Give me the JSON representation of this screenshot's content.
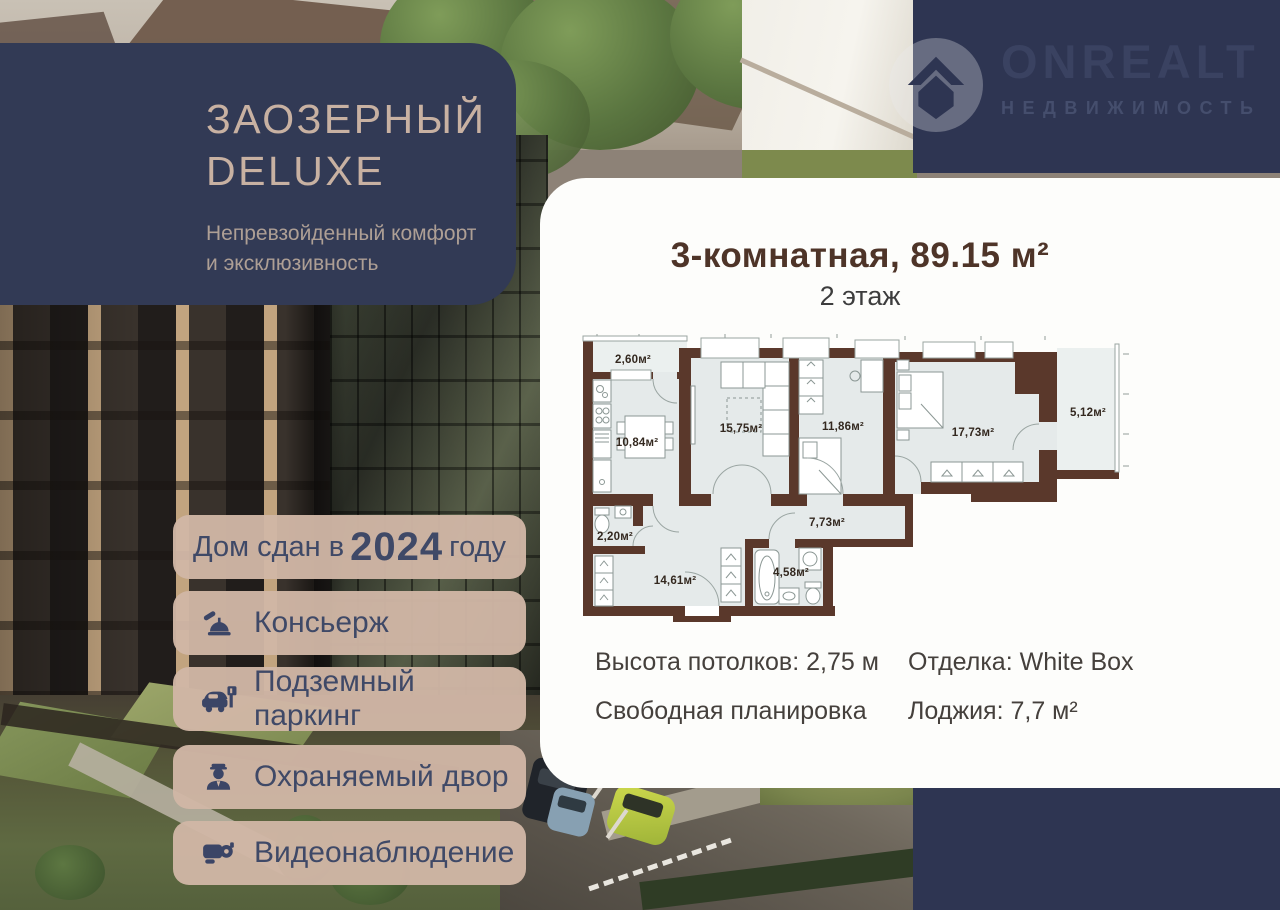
{
  "brand": {
    "logo_text": "ONREALT",
    "logo_sub": "НЕДВИЖИМОСТЬ"
  },
  "promo": {
    "title_line1": "ЗАОЗЕРНЫЙ",
    "title_line2": "DELUXE",
    "subtitle_line1": "Непревзойденный комфорт",
    "subtitle_line2": "и эксклюзивность"
  },
  "badges": {
    "completion": {
      "prefix": "Дом сдан в",
      "year": "2024",
      "suffix": "году"
    },
    "items": [
      {
        "icon": "bell-icon",
        "label": "Консьерж"
      },
      {
        "icon": "parking-icon",
        "label": "Подземный паркинг"
      },
      {
        "icon": "guard-icon",
        "label": "Охраняемый двор"
      },
      {
        "icon": "camera-icon",
        "label": "Видеонаблюдение"
      }
    ]
  },
  "listing": {
    "title": "3-комнатная, 89.15 м²",
    "floor": "2 этаж",
    "specs": [
      {
        "label": "Высота потолков: 2,75 м"
      },
      {
        "label": "Отделка: White Box"
      },
      {
        "label": "Свободная планировка"
      },
      {
        "label": "Лоджия: 7,7 м²"
      }
    ]
  },
  "floor_plan": {
    "rooms": [
      {
        "name": "balcony-top",
        "area": "2,60м²",
        "x": 58,
        "y": 29
      },
      {
        "name": "kitchen",
        "area": "10,84м²",
        "x": 62,
        "y": 112
      },
      {
        "name": "living-room",
        "area": "15,75м²",
        "x": 166,
        "y": 98
      },
      {
        "name": "bedroom-1",
        "area": "11,86м²",
        "x": 268,
        "y": 96
      },
      {
        "name": "bedroom-2",
        "area": "17,73м²",
        "x": 398,
        "y": 102
      },
      {
        "name": "loggia",
        "area": "5,12м²",
        "x": 513,
        "y": 82
      },
      {
        "name": "wc",
        "area": "2,20м²",
        "x": 40,
        "y": 206
      },
      {
        "name": "hallway",
        "area": "7,73м²",
        "x": 252,
        "y": 192
      },
      {
        "name": "hall-room",
        "area": "14,61м²",
        "x": 100,
        "y": 250
      },
      {
        "name": "bathroom",
        "area": "4,58м²",
        "x": 216,
        "y": 242
      }
    ]
  },
  "colors": {
    "navy": "#2e3552",
    "promo_navy": "#323a55",
    "promo_title": "#c8b1a2",
    "badge_bg": "#d0b6a5",
    "badge_text": "#3f4967",
    "card_bg": "#fdfdfb",
    "title_brown": "#4e3428",
    "wall_brown": "#5a382b",
    "room_fill": "#e5eaea"
  }
}
